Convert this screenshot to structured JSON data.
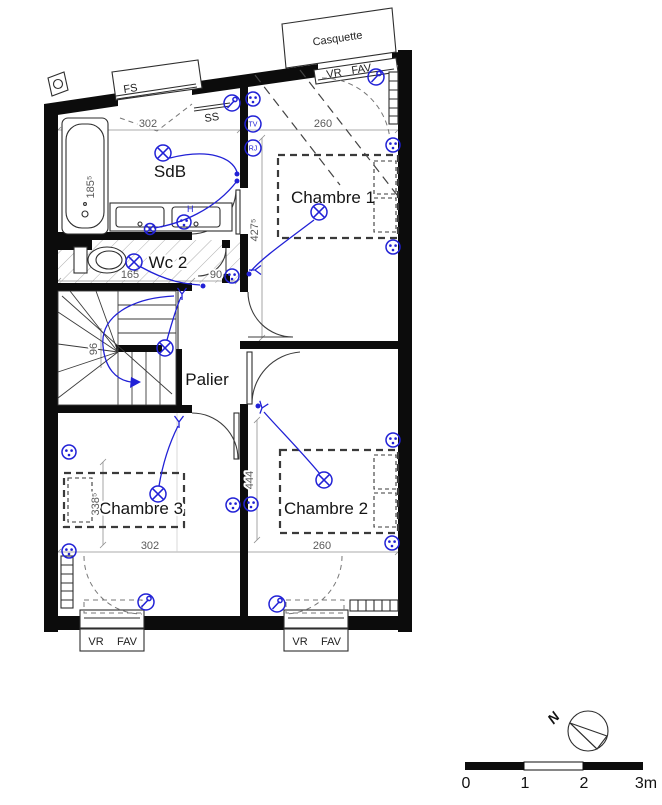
{
  "theme": {
    "paper": "#ffffff",
    "wall": "#0c0c0c",
    "line": "#2e2e2e",
    "electric": "#2121d6",
    "dim": "#8f8f8f"
  },
  "rooms": {
    "sdb": "SdB",
    "wc2": "Wc 2",
    "chambre1": "Chambre 1",
    "chambre2": "Chambre 2",
    "chambre3": "Chambre 3",
    "palier": "Palier"
  },
  "annotations": {
    "casquette": "Casquette",
    "roof_window": "FS",
    "ss": "SS",
    "high_socket": "H"
  },
  "windows": {
    "top": {
      "vr": "VR",
      "fav": "FAV"
    },
    "bottom_left": {
      "vr": "VR",
      "fav": "FAV"
    },
    "bottom_right": {
      "vr": "VR",
      "fav": "FAV"
    }
  },
  "outlets": {
    "tv": "TV",
    "rj": "RJ"
  },
  "dimensions": {
    "sdb_width": "302",
    "chambre1_width": "260",
    "bath_length": "185⁵",
    "chambre1_depth": "427⁵",
    "wc2_width": "165",
    "passage": "90",
    "stair_width": "96",
    "chambre3_depth": "338⁵",
    "chambre2_depth": "444",
    "chambre3_width": "302",
    "chambre2_width": "260"
  },
  "scale_bar": {
    "t0": "0",
    "t1": "1",
    "t2": "2",
    "t3": "3m"
  },
  "compass": {
    "label": "N"
  }
}
